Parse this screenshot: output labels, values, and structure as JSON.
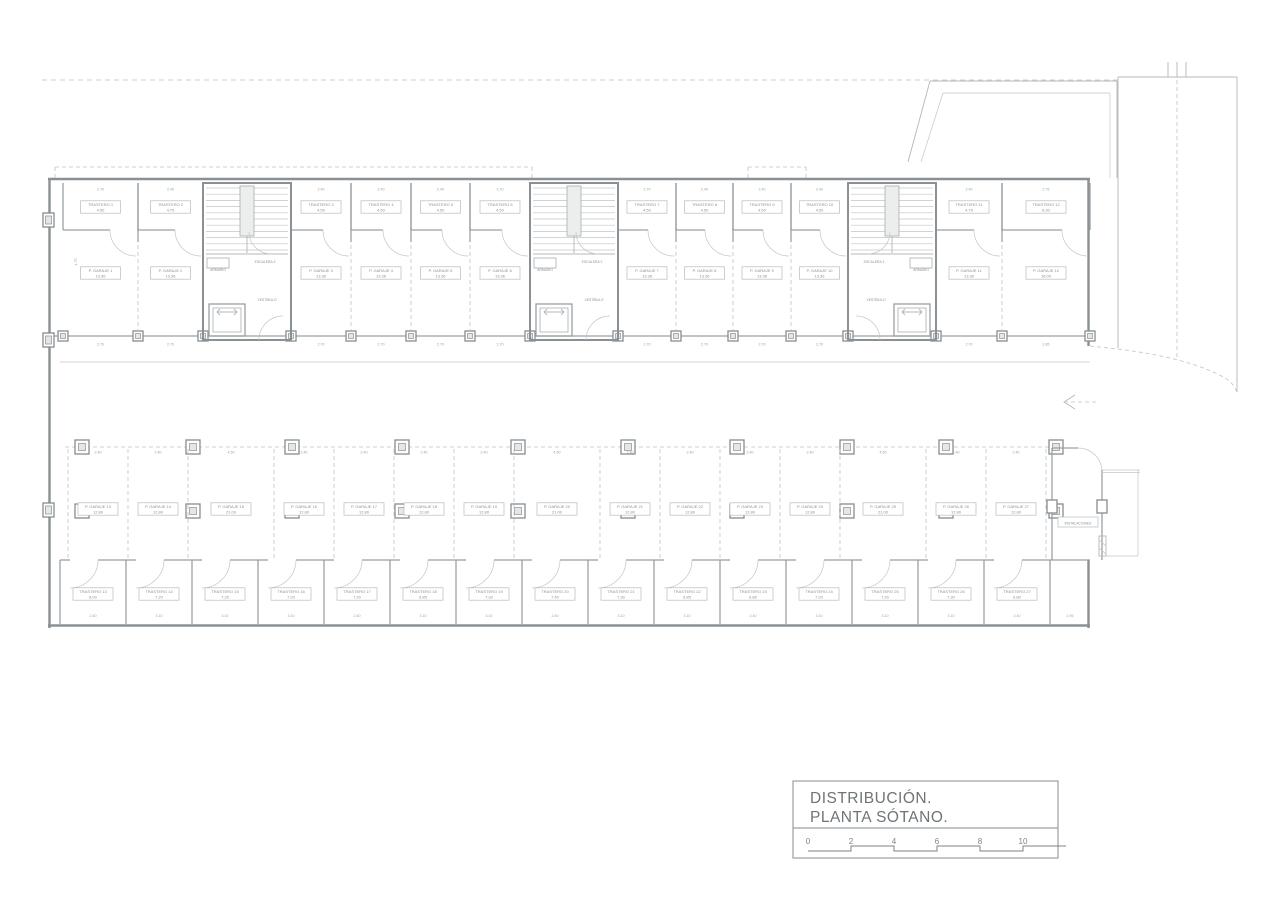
{
  "drawing": {
    "type": "architectural-floor-plan",
    "colors": {
      "background": "#ffffff",
      "wall": "#8a9093",
      "line": "#c2c6c8",
      "text": "#8b9194",
      "title_text": "#6e7478"
    }
  },
  "title_block": {
    "line1": "DISTRIBUCIÓN.",
    "line2": "PLANTA SÓTANO.",
    "scale_ticks": [
      "0",
      "2",
      "4",
      "6",
      "8",
      "10"
    ]
  },
  "stair_cores": [
    {
      "name": "ESCALERA 3",
      "closet": "ARMARIO",
      "lobby": "VESTÍBULO"
    },
    {
      "name": "ESCALERA 2",
      "closet": "ARMARIO",
      "lobby": "VESTÍBULO"
    },
    {
      "name": "ESCALERA 1",
      "closet": "ARMARIO",
      "lobby": "VESTÍBULO"
    }
  ],
  "top_row": {
    "trasteros": [
      {
        "label": "TRASTERO 1",
        "area": "4.50"
      },
      {
        "label": "TRASTERO 2",
        "area": "4.75"
      },
      {
        "label": "TRASTERO 3",
        "area": "4.50"
      },
      {
        "label": "TRASTERO 4",
        "area": "4.50"
      },
      {
        "label": "TRASTERO 5",
        "area": "4.50"
      },
      {
        "label": "TRASTERO 6",
        "area": "4.50"
      },
      {
        "label": "TRASTERO 7",
        "area": "4.50"
      },
      {
        "label": "TRASTERO 8",
        "area": "4.50"
      },
      {
        "label": "TRASTERO 9",
        "area": "4.50"
      },
      {
        "label": "TRASTERO 10",
        "area": "4.50"
      },
      {
        "label": "TRASTERO 11",
        "area": "4.75"
      },
      {
        "label": "TRASTERO 12",
        "area": "6.30"
      }
    ],
    "garajes": [
      {
        "label": "P. GARAJE 1",
        "area": "13.36"
      },
      {
        "label": "P. GARAJE 2",
        "area": "13.36"
      },
      {
        "label": "P. GARAJE 3",
        "area": "13.36"
      },
      {
        "label": "P. GARAJE 4",
        "area": "13.36"
      },
      {
        "label": "P. GARAJE 5",
        "area": "13.36"
      },
      {
        "label": "P. GARAJE 6",
        "area": "13.36"
      },
      {
        "label": "P. GARAJE 7",
        "area": "13.36"
      },
      {
        "label": "P. GARAJE 8",
        "area": "13.36"
      },
      {
        "label": "P. GARAJE 9",
        "area": "13.36"
      },
      {
        "label": "P. GARAJE 10",
        "area": "13.36"
      },
      {
        "label": "P. GARAJE 11",
        "area": "13.36"
      },
      {
        "label": "P. GARAJE 12",
        "area": "16.00"
      }
    ],
    "top_dims": [
      "2.70",
      "2.40",
      "2.40",
      "2.40",
      "2.40",
      "2.70",
      "2.70",
      "2.40",
      "2.40",
      "2.40",
      "2.40",
      "2.75"
    ],
    "bottom_dims": [
      "2.70",
      "2.70",
      "2.70",
      "2.70",
      "2.70",
      "2.70",
      "2.70",
      "2.70",
      "2.70",
      "2.70",
      "2.70",
      "2.85"
    ]
  },
  "middle_row": {
    "garajes": [
      {
        "label": "P. GARAJE 13",
        "area": "12.80"
      },
      {
        "label": "P. GARAJE 14",
        "area": "12.80"
      },
      {
        "label": "P. GARAJE 15",
        "area": "21.00"
      },
      {
        "label": "P. GARAJE 16",
        "area": "12.80"
      },
      {
        "label": "P. GARAJE 17",
        "area": "12.80"
      },
      {
        "label": "P. GARAJE 18",
        "area": "12.80"
      },
      {
        "label": "P. GARAJE 19",
        "area": "12.80"
      },
      {
        "label": "P. GARAJE 20",
        "area": "21.00"
      },
      {
        "label": "P. GARAJE 21",
        "area": "12.80"
      },
      {
        "label": "P. GARAJE 22",
        "area": "12.80"
      },
      {
        "label": "P. GARAJE 23",
        "area": "12.80"
      },
      {
        "label": "P. GARAJE 24",
        "area": "12.80"
      },
      {
        "label": "P. GARAJE 25",
        "area": "21.00"
      },
      {
        "label": "P. GARAJE 26",
        "area": "12.80"
      },
      {
        "label": "P. GARAJE 27",
        "area": "12.80"
      }
    ],
    "top_dims": [
      "2.40",
      "2.40",
      "4.50",
      "2.40",
      "2.40",
      "2.40",
      "2.40",
      "4.50",
      "2.40",
      "2.40",
      "2.40",
      "2.40",
      "4.50",
      "2.40",
      "2.40"
    ]
  },
  "bottom_row": {
    "trasteros": [
      {
        "label": "TRASTERO 13",
        "area": "8.00"
      },
      {
        "label": "TRASTERO 14",
        "area": "7.20"
      },
      {
        "label": "TRASTERO 15",
        "area": "7.25"
      },
      {
        "label": "TRASTERO 16",
        "area": "7.20"
      },
      {
        "label": "TRASTERO 17",
        "area": "7.20"
      },
      {
        "label": "TRASTERO 18",
        "area": "6.85"
      },
      {
        "label": "TRASTERO 19",
        "area": "7.30"
      },
      {
        "label": "TRASTERO 20",
        "area": "7.40"
      },
      {
        "label": "TRASTERO 21",
        "area": "7.30"
      },
      {
        "label": "TRASTERO 22",
        "area": "6.85"
      },
      {
        "label": "TRASTERO 23",
        "area": "6.85"
      },
      {
        "label": "TRASTERO 24",
        "area": "7.20"
      },
      {
        "label": "TRASTERO 25",
        "area": "7.20"
      },
      {
        "label": "TRASTERO 26",
        "area": "7.30"
      },
      {
        "label": "TRASTERO 27",
        "area": "6.80"
      }
    ],
    "bottom_dims": [
      "2.40",
      "3.10",
      "3.10",
      "3.10",
      "2.40",
      "3.10",
      "3.10",
      "2.40",
      "3.10",
      "3.10",
      "2.40",
      "3.10",
      "3.10",
      "3.10",
      "2.40"
    ]
  },
  "utility_room": {
    "label": "INSTALACIONES"
  },
  "misc": {
    "left_height_dim": "4.75",
    "right_corner_dim": "1.95"
  }
}
